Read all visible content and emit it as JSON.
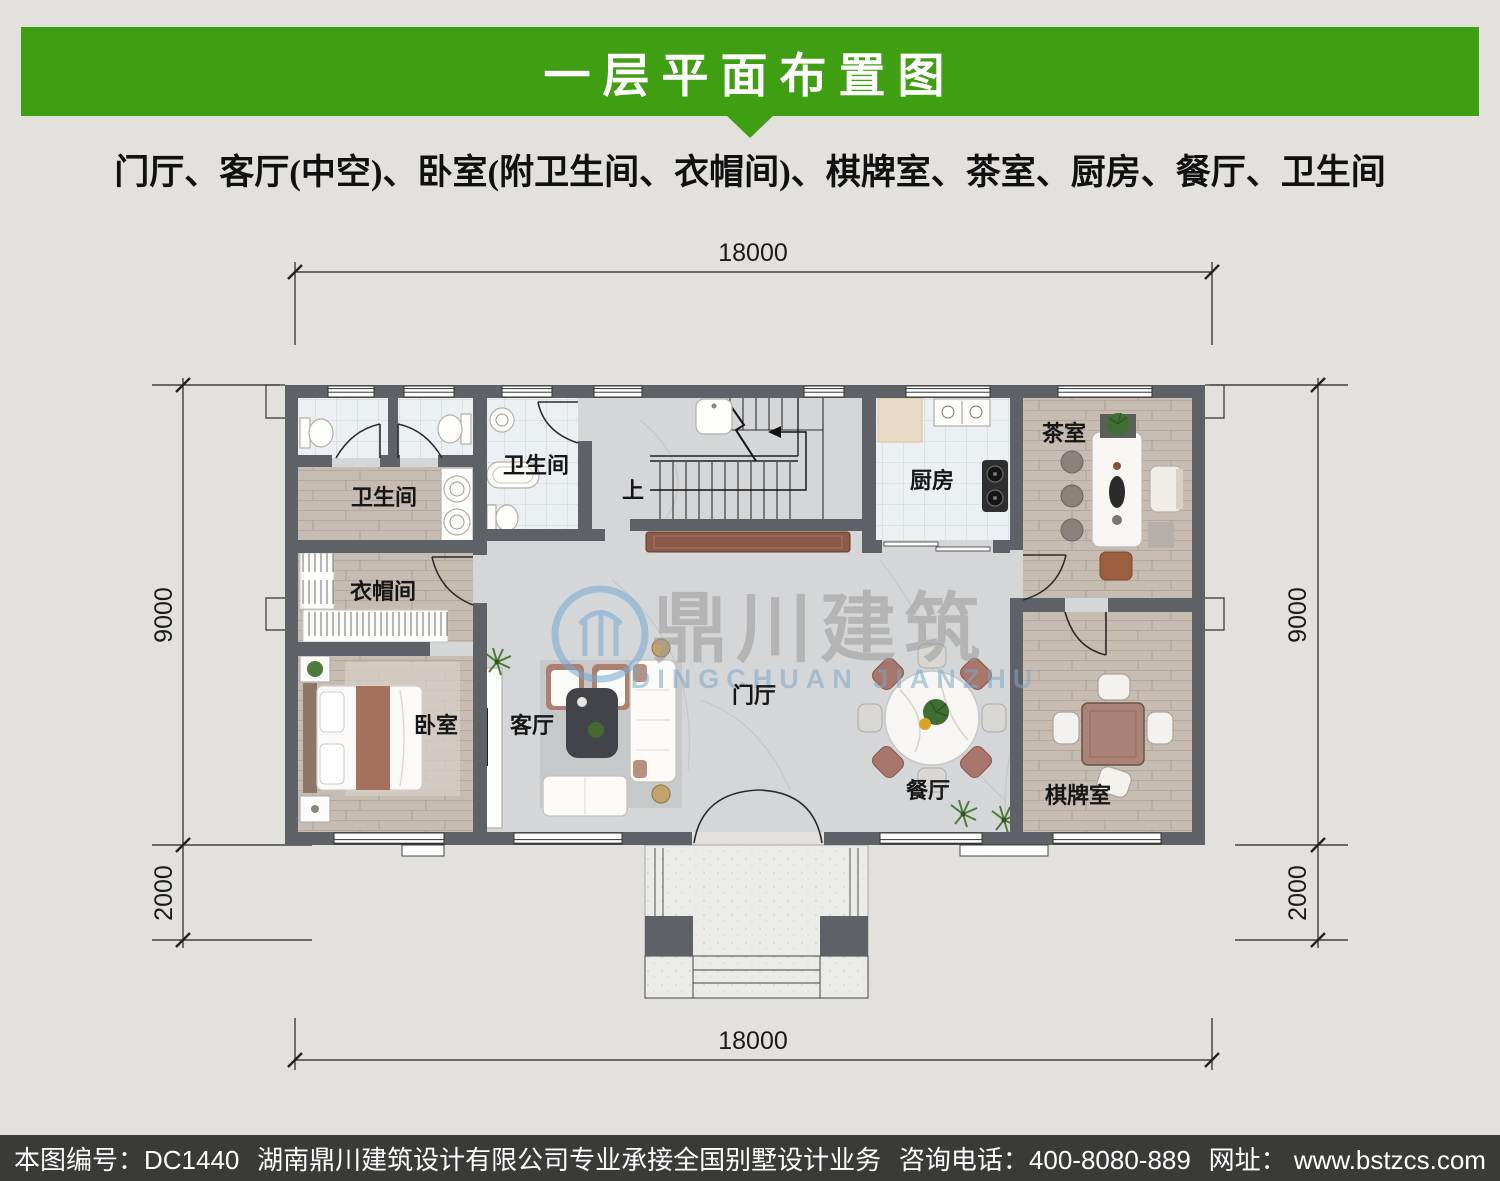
{
  "header": {
    "title": "一层平面布置图"
  },
  "subtitle": "门厅、客厅(中空)、卧室(附卫生间、衣帽间)、棋牌室、茶室、厨房、餐厅、卫生间",
  "watermark": {
    "cn": "鼎川建筑",
    "en": "DINGCHUAN JIANZHU"
  },
  "plan": {
    "dims": {
      "width": "18000",
      "depth": "9000",
      "porch": "2000"
    },
    "stairs_up": "上",
    "rooms": {
      "bath_inner": "卫生间",
      "bath_main": "卫生间",
      "cloakroom": "衣帽间",
      "bedroom": "卧室",
      "living": "客厅",
      "foyer": "门厅",
      "dining": "餐厅",
      "kitchen": "厨房",
      "tea": "茶室",
      "chess": "棋牌室"
    }
  },
  "footer": {
    "serial": "本图编号：DC1440",
    "company": "湖南鼎川建筑设计有限公司专业承接全国别墅设计业务",
    "phone": "咨询电话：400-8080-889",
    "website": "网址： www.bstzcs.com"
  },
  "colors": {
    "banner_green": "#3f9e11",
    "footer_bar": "#3a3a38",
    "wall_gray": "#5e6166",
    "watermark_blue": "#7fa8c6"
  }
}
